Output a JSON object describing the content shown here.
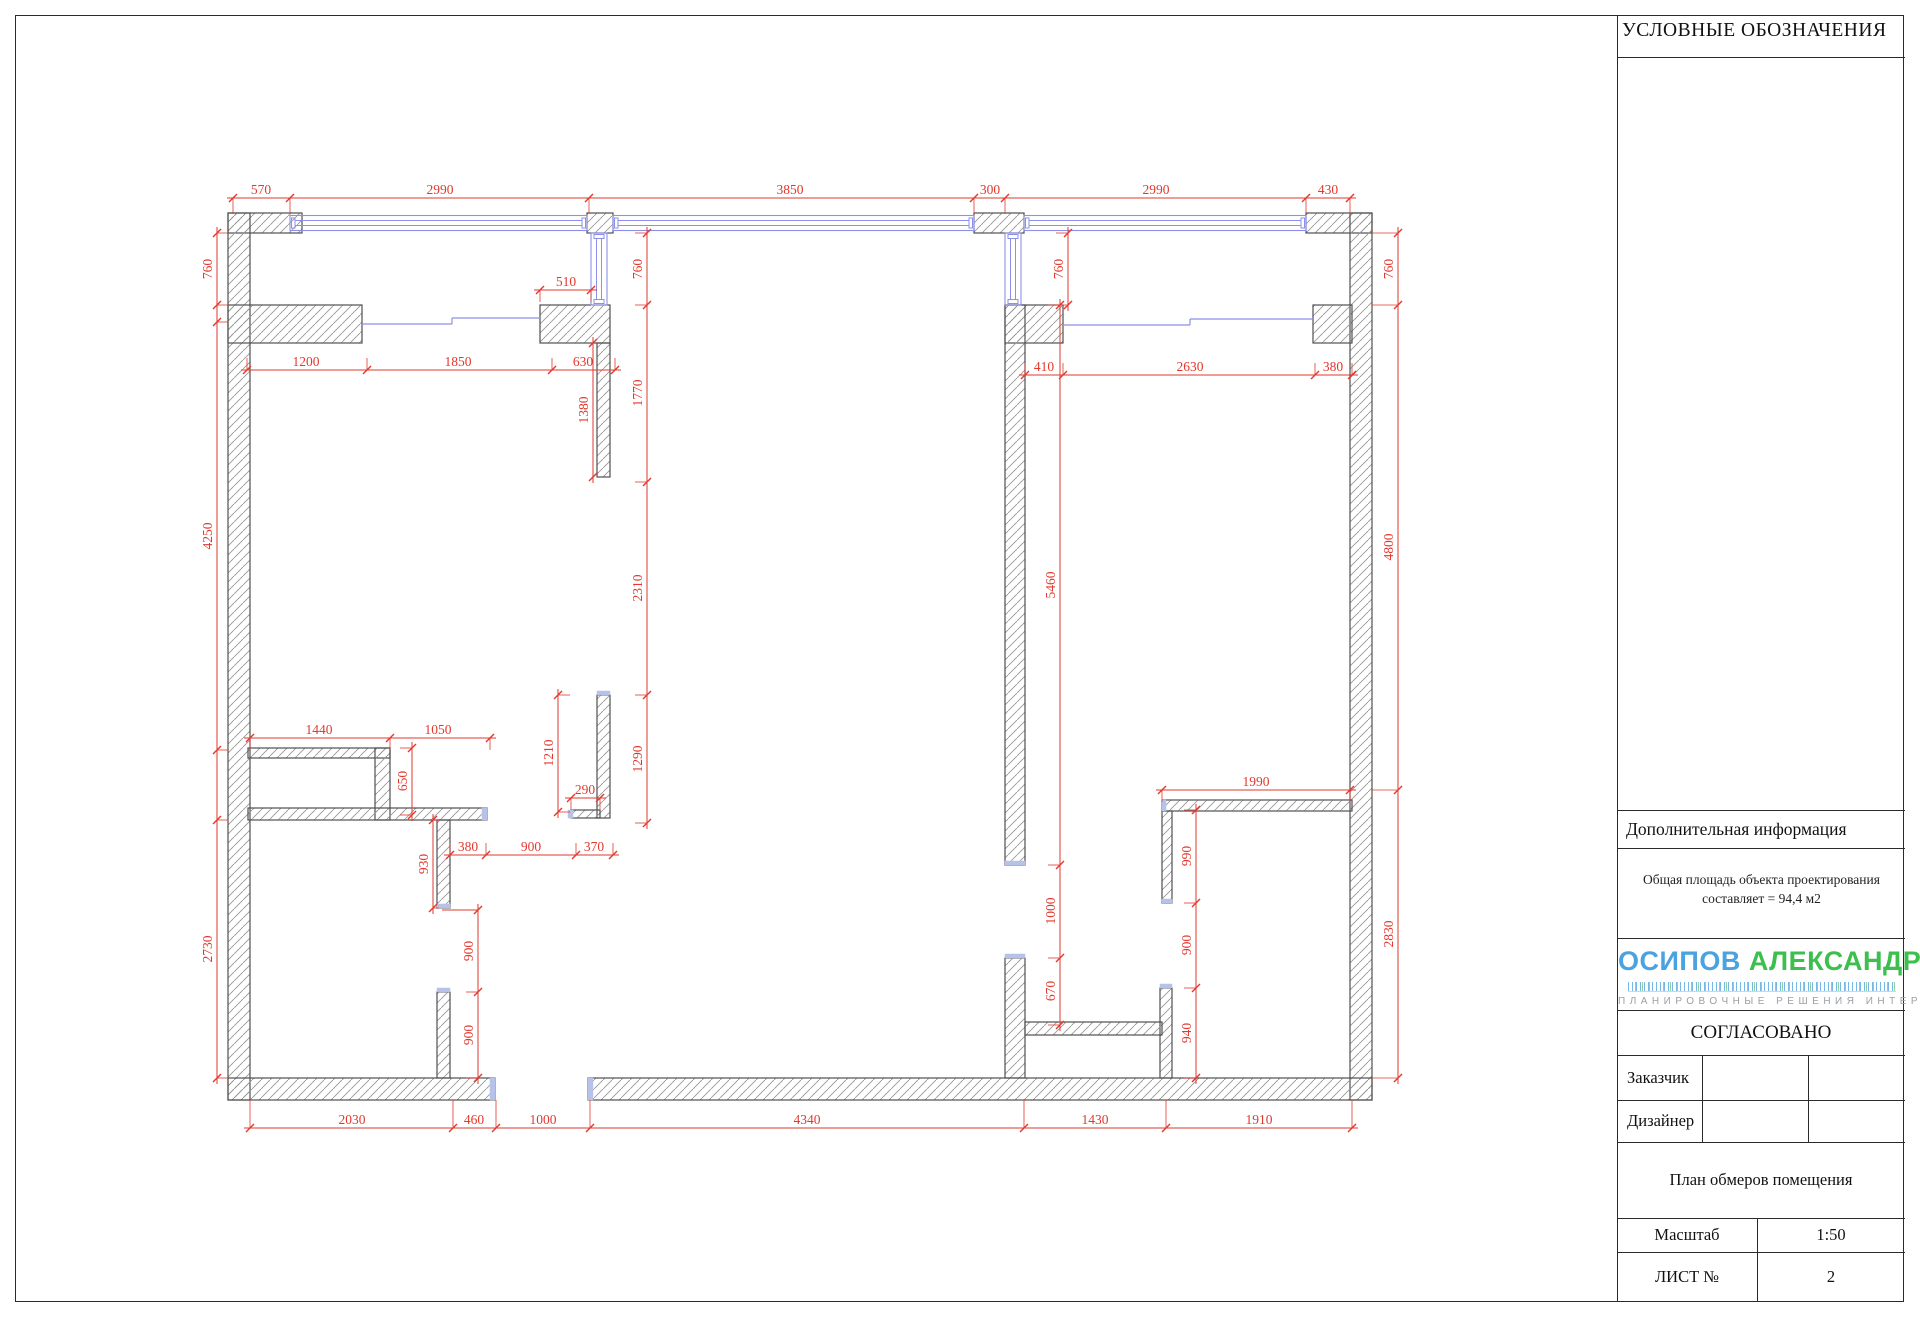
{
  "legend": {
    "title": "УСЛОВНЫЕ ОБОЗНАЧЕНИЯ"
  },
  "info": {
    "header": "Дополнительная информация",
    "line1": "Общая площадь объекта проектирования",
    "line2": "составляет = 94,4 м2"
  },
  "logo": {
    "first": "ОСИПОВ",
    "second": "АЛЕКСАНДР",
    "first_color": "#4aa3e0",
    "second_color": "#3cbf4d",
    "tagline": "ПЛАНИРОВОЧНЫЕ РЕШЕНИЯ ИНТЕРЬЕРОВ"
  },
  "approval": {
    "header": "СОГЛАСОВАНО",
    "rows": [
      {
        "label": "Заказчик"
      },
      {
        "label": "Дизайнер"
      }
    ]
  },
  "titleblock": {
    "plan_title": "План обмеров помещения",
    "scale_label": "Масштаб",
    "scale_value": "1:50",
    "sheet_label": "ЛИСТ №",
    "sheet_value": "2"
  },
  "plan": {
    "colors": {
      "dim": "#e2382e",
      "wall_stroke": "#4f4f4f",
      "hatch": "#979797",
      "window": "#8c90e8",
      "cap": "#b7c2e8"
    },
    "walls": [
      [
        228,
        213,
        74,
        20
      ],
      [
        587,
        213,
        26,
        20
      ],
      [
        974,
        213,
        50,
        20
      ],
      [
        1306,
        213,
        66,
        20
      ],
      [
        228,
        213,
        22,
        887
      ],
      [
        1350,
        213,
        22,
        887
      ],
      [
        228,
        1078,
        267,
        22
      ],
      [
        588,
        1078,
        784,
        22
      ],
      [
        228,
        305,
        134,
        38
      ],
      [
        540,
        305,
        70,
        38
      ],
      [
        1005,
        305,
        58,
        38
      ],
      [
        1313,
        305,
        39,
        38
      ],
      [
        597,
        343,
        13,
        134
      ],
      [
        597,
        695,
        13,
        123
      ],
      [
        571,
        810,
        29,
        8
      ],
      [
        1005,
        305,
        20,
        560
      ],
      [
        1005,
        958,
        20,
        120
      ],
      [
        248,
        748,
        142,
        10
      ],
      [
        375,
        748,
        15,
        72
      ],
      [
        248,
        808,
        239,
        12
      ],
      [
        437,
        820,
        13,
        88
      ],
      [
        437,
        992,
        13,
        86
      ],
      [
        1162,
        800,
        190,
        11
      ],
      [
        1162,
        811,
        10,
        92
      ],
      [
        1160,
        988,
        12,
        90
      ],
      [
        1025,
        1022,
        137,
        13
      ]
    ],
    "windows_h": [
      [
        290,
        587
      ],
      [
        613,
        974
      ],
      [
        1024,
        1306
      ]
    ],
    "windows_v": [
      [
        591,
        233,
        305
      ],
      [
        1005,
        233,
        305
      ]
    ],
    "sills": [
      [
        362,
        324,
        452,
        324
      ],
      [
        452,
        318,
        452,
        324
      ],
      [
        452,
        318,
        540,
        318
      ],
      [
        1063,
        325,
        1190,
        325
      ],
      [
        1190,
        319,
        1190,
        325
      ],
      [
        1190,
        319,
        1313,
        319
      ]
    ],
    "caps": [
      [
        597,
        691,
        13,
        4
      ],
      [
        568,
        810,
        5,
        8
      ],
      [
        482,
        808,
        5,
        12
      ],
      [
        490,
        1078,
        5,
        22
      ],
      [
        588,
        1078,
        5,
        22
      ],
      [
        437,
        904,
        13,
        4
      ],
      [
        437,
        988,
        13,
        4
      ],
      [
        1005,
        861,
        20,
        4
      ],
      [
        1005,
        954,
        20,
        4
      ],
      [
        1162,
        899,
        10,
        4
      ],
      [
        1160,
        984,
        12,
        4
      ],
      [
        1162,
        800,
        4,
        11
      ]
    ],
    "extra_lines": [
      [
        442,
        910,
        478,
        910
      ]
    ],
    "chains": [
      {
        "dir": "h",
        "pos": 198,
        "ext": 16,
        "ticks": [
          233,
          290,
          589,
          974,
          1005,
          1306,
          1350
        ],
        "labels": [
          {
            "text": "570",
            "at": 261
          },
          {
            "text": "2990",
            "at": 440
          },
          {
            "text": "3850",
            "at": 790
          },
          {
            "text": "300",
            "at": 990
          },
          {
            "text": "2990",
            "at": 1156
          },
          {
            "text": "430",
            "at": 1328
          }
        ]
      },
      {
        "dir": "v",
        "pos": 217,
        "ext": 11,
        "ticks": [
          233,
          305,
          322,
          750,
          820,
          1078
        ],
        "labels": [
          {
            "text": "760",
            "at": 269
          },
          {
            "text": "4250",
            "at": 536
          },
          {
            "text": "2730",
            "at": 949
          }
        ]
      },
      {
        "dir": "h",
        "pos": 1128,
        "ext": -28,
        "ticks": [
          250,
          453,
          496,
          590,
          1024,
          1166,
          1352
        ],
        "labels": [
          {
            "text": "2030",
            "at": 352
          },
          {
            "text": "460",
            "at": 474
          },
          {
            "text": "1000",
            "at": 543
          },
          {
            "text": "4340",
            "at": 807
          },
          {
            "text": "1430",
            "at": 1095
          },
          {
            "text": "1910",
            "at": 1259
          }
        ]
      },
      {
        "dir": "v",
        "pos": 1398,
        "ext": -26,
        "ticks": [
          233,
          305,
          790,
          1078
        ],
        "labels": [
          {
            "text": "760",
            "at": 269
          },
          {
            "text": "4800",
            "at": 547
          },
          {
            "text": "2830",
            "at": 934
          }
        ]
      },
      {
        "dir": "h",
        "pos": 370,
        "ext": -12,
        "ticks": [
          247,
          367,
          552,
          615
        ],
        "labels": [
          {
            "text": "1200",
            "at": 306
          },
          {
            "text": "1850",
            "at": 458
          },
          {
            "text": "630",
            "at": 583
          }
        ]
      },
      {
        "dir": "h",
        "pos": 290,
        "ext": 12,
        "ticks": [
          540,
          591
        ],
        "labels": [
          {
            "text": "510",
            "at": 566
          }
        ]
      },
      {
        "dir": "h",
        "pos": 375,
        "ext": -12,
        "ticks": [
          1025,
          1063,
          1315,
          1352
        ],
        "labels": [
          {
            "text": "410",
            "at": 1044
          },
          {
            "text": "2630",
            "at": 1190
          },
          {
            "text": "380",
            "at": 1333
          }
        ]
      },
      {
        "dir": "v",
        "pos": 647,
        "ext": -12,
        "ticks": [
          233,
          305,
          482,
          695,
          823
        ],
        "labels": [
          {
            "text": "760",
            "at": 269
          },
          {
            "text": "1770",
            "at": 393
          },
          {
            "text": "2310",
            "at": 588
          },
          {
            "text": "1290",
            "at": 759
          }
        ]
      },
      {
        "dir": "v",
        "pos": 1068,
        "ext": -12,
        "ticks": [
          233,
          305
        ],
        "labels": [
          {
            "text": "760",
            "at": 269
          }
        ]
      },
      {
        "dir": "v",
        "pos": 593,
        "ext": 0,
        "ticks": [
          343,
          477
        ],
        "labels": [
          {
            "text": "1380",
            "at": 410
          }
        ]
      },
      {
        "dir": "v",
        "pos": 558,
        "ext": 12,
        "ticks": [
          695,
          812
        ],
        "labels": [
          {
            "text": "1210",
            "at": 753
          }
        ]
      },
      {
        "dir": "h",
        "pos": 798,
        "ext": 12,
        "ticks": [
          571,
          600
        ],
        "labels": [
          {
            "text": "290",
            "at": 585
          }
        ]
      },
      {
        "dir": "h",
        "pos": 738,
        "ext": 12,
        "ticks": [
          250,
          390,
          490
        ],
        "labels": [
          {
            "text": "1440",
            "at": 319
          },
          {
            "text": "1050",
            "at": 438
          }
        ]
      },
      {
        "dir": "v",
        "pos": 412,
        "ext": -12,
        "ticks": [
          748,
          815
        ],
        "labels": [
          {
            "text": "650",
            "at": 781
          }
        ]
      },
      {
        "dir": "h",
        "pos": 855,
        "ext": -12,
        "ticks": [
          450,
          486,
          576,
          613
        ],
        "labels": [
          {
            "text": "380",
            "at": 468
          },
          {
            "text": "900",
            "at": 531
          },
          {
            "text": "370",
            "at": 594
          }
        ]
      },
      {
        "dir": "v",
        "pos": 433,
        "ext": 6,
        "ticks": [
          820,
          908
        ],
        "labels": [
          {
            "text": "930",
            "at": 864
          }
        ]
      },
      {
        "dir": "v",
        "pos": 478,
        "ext": -12,
        "ticks": [
          910,
          992,
          1078
        ],
        "labels": [
          {
            "text": "900",
            "at": 951
          },
          {
            "text": "900",
            "at": 1035
          }
        ]
      },
      {
        "dir": "v",
        "pos": 1060,
        "ext": -12,
        "ticks": [
          305,
          865,
          958,
          1025
        ],
        "labels": [
          {
            "text": "5460",
            "at": 585
          },
          {
            "text": "1000",
            "at": 911
          },
          {
            "text": "670",
            "at": 991
          }
        ]
      },
      {
        "dir": "h",
        "pos": 790,
        "ext": 12,
        "ticks": [
          1162,
          1350
        ],
        "labels": [
          {
            "text": "1990",
            "at": 1256
          }
        ]
      },
      {
        "dir": "v",
        "pos": 1196,
        "ext": -12,
        "ticks": [
          810,
          903,
          988,
          1078
        ],
        "labels": [
          {
            "text": "990",
            "at": 856
          },
          {
            "text": "900",
            "at": 945
          },
          {
            "text": "940",
            "at": 1033
          }
        ]
      }
    ]
  }
}
